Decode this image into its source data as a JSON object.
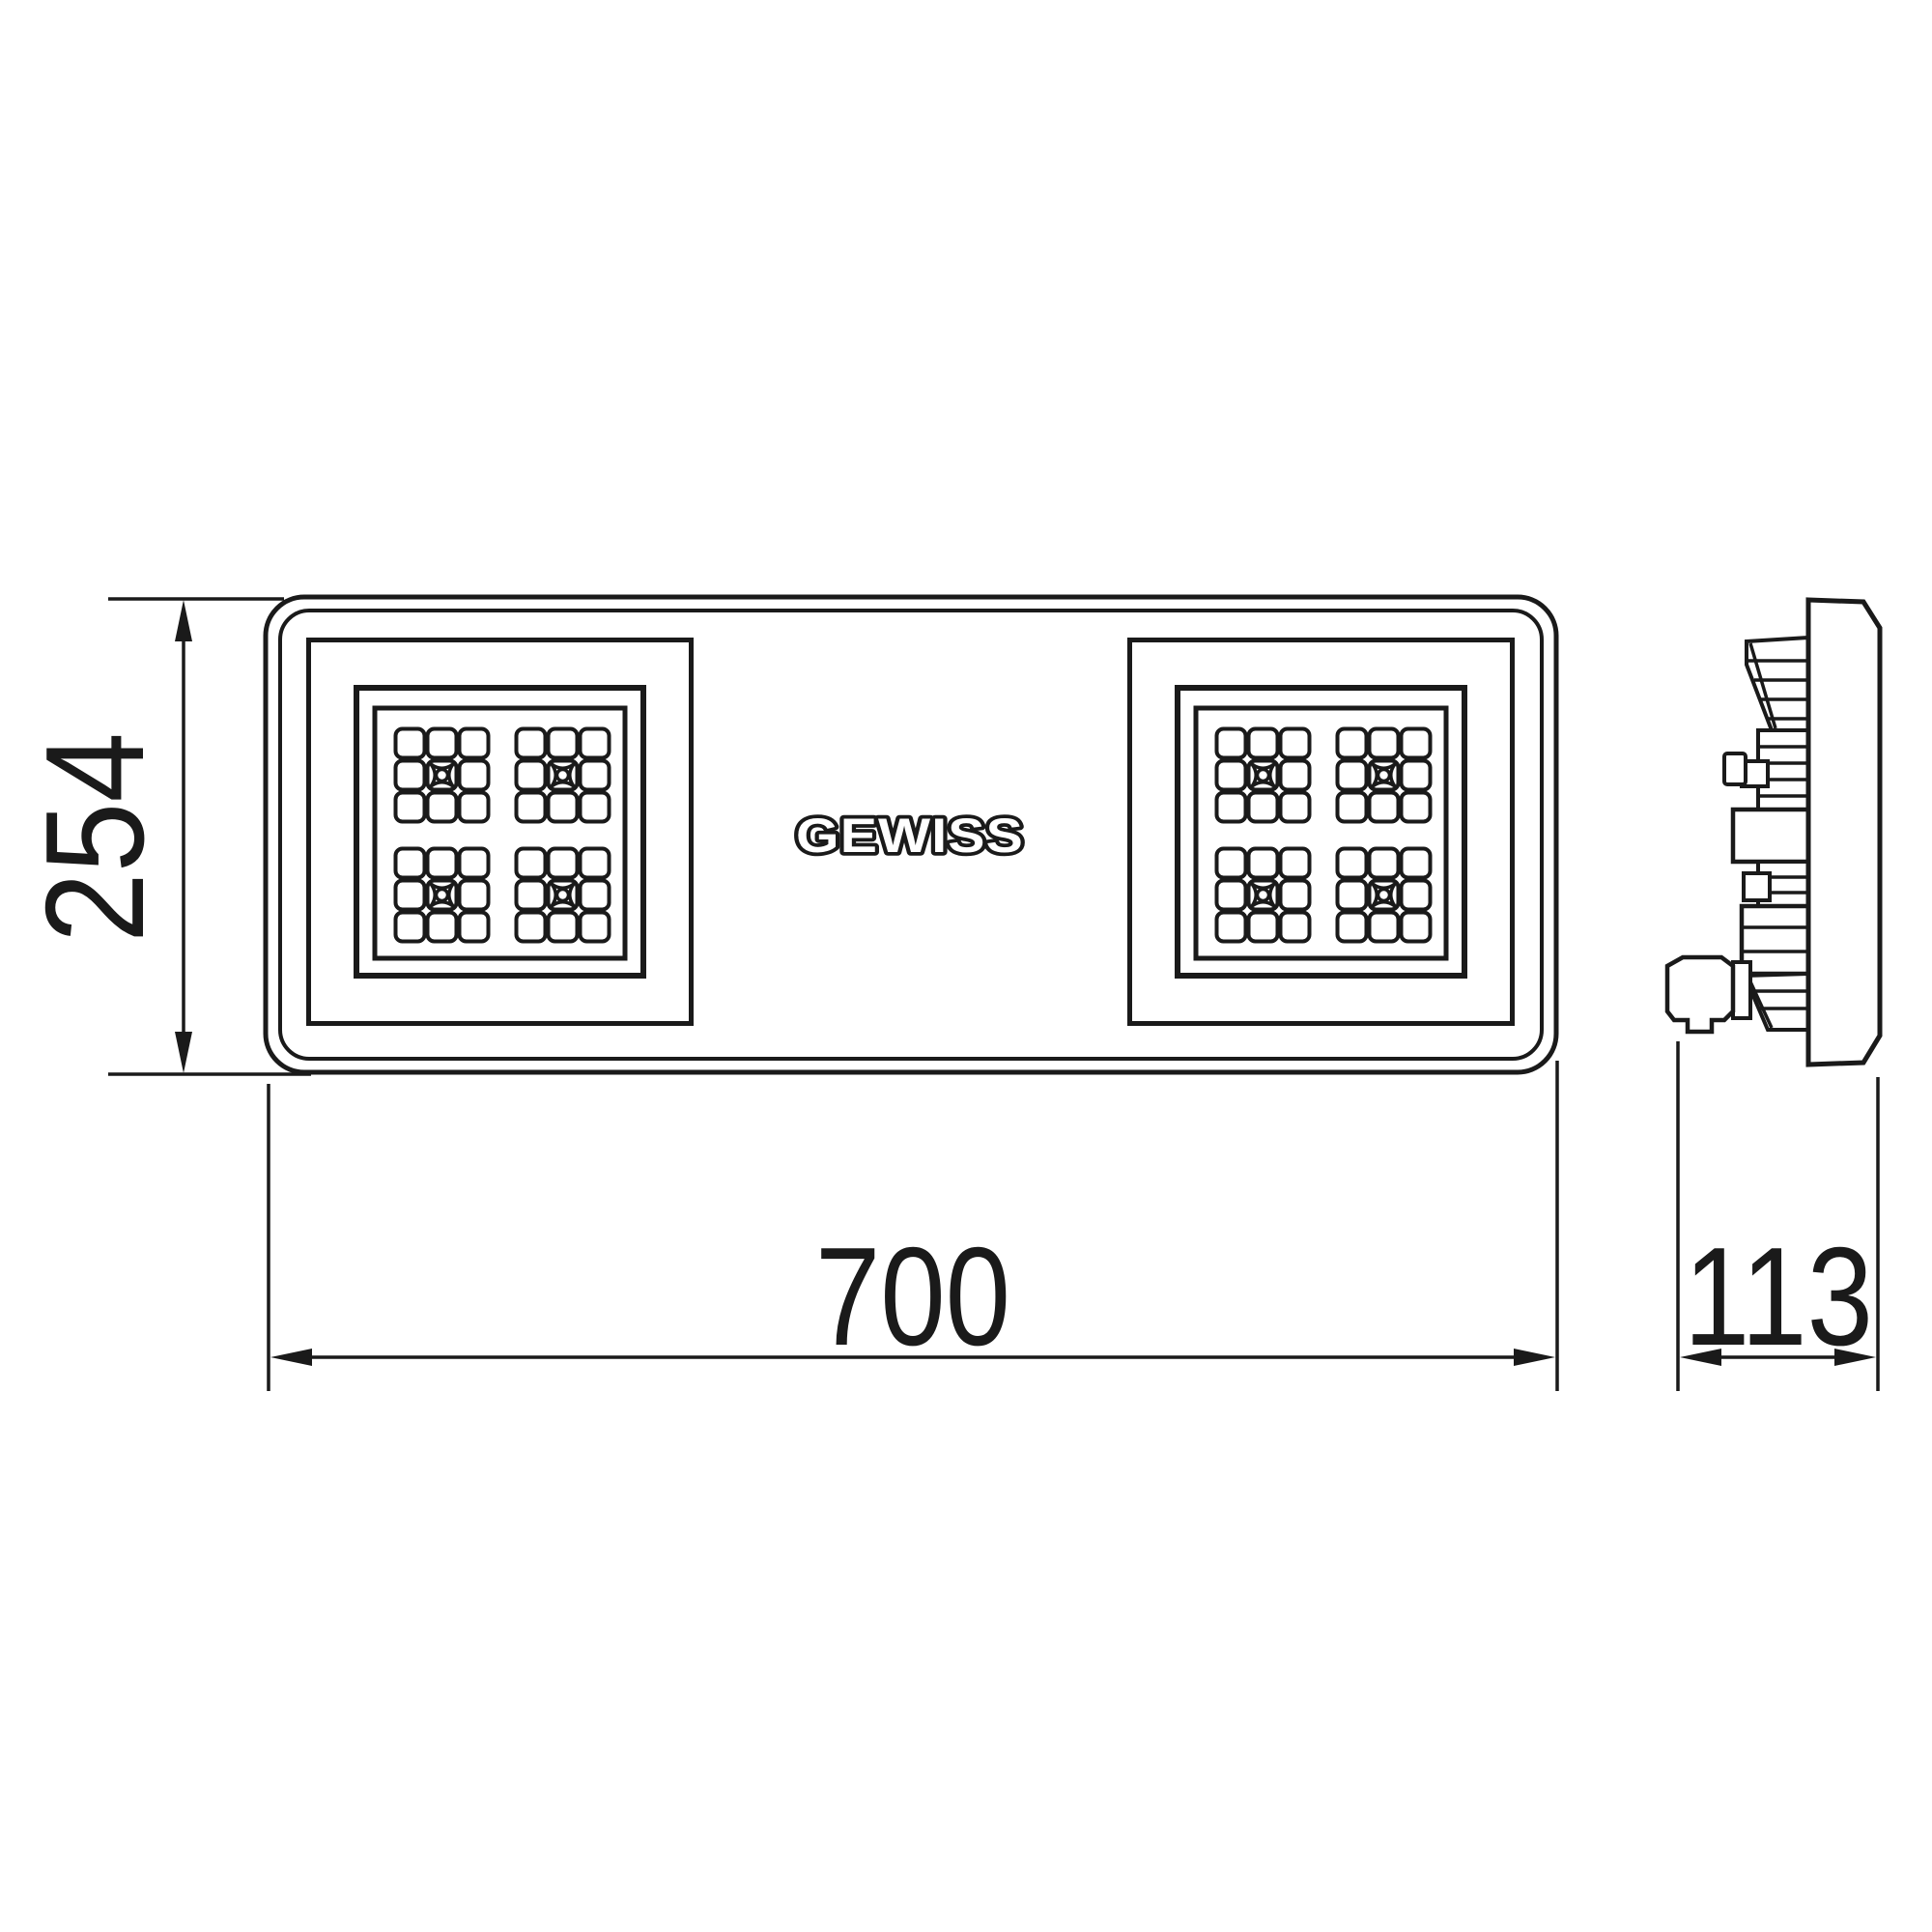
{
  "logo": {
    "text": "GEWISS"
  },
  "dimensions": {
    "height": {
      "value": "254",
      "orientation": "vertical",
      "side": "left"
    },
    "width": {
      "value": "700",
      "orientation": "horizontal",
      "side": "bottom"
    },
    "depth": {
      "value": "113",
      "orientation": "horizontal",
      "side": "bottom-right"
    }
  },
  "views": {
    "front": {
      "label": "front view",
      "led_modules": 2,
      "clusters_per_module": 4,
      "cells_per_cluster": 9
    },
    "side": {
      "label": "side profile view"
    }
  },
  "colors": {
    "line": "#1a1a1a",
    "background": "#ffffff"
  }
}
